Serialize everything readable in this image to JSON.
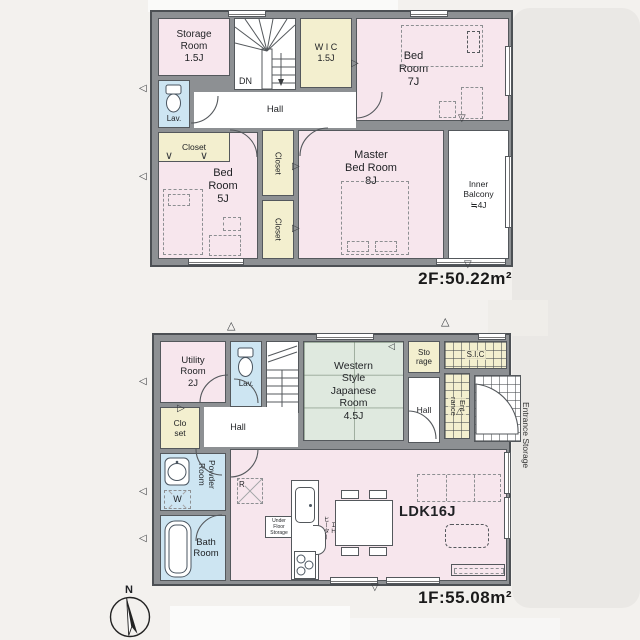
{
  "colors": {
    "room_pink": "#f7e6ed",
    "room_cream": "#f3efcf",
    "room_blue": "#cde5f2",
    "room_green": "#dfe9df",
    "wall": "#8d9093",
    "line": "#54585c",
    "bg": "#f3f1ee"
  },
  "icons": {
    "vent_left": "◁",
    "vent_right": "▷",
    "vent_up": "△",
    "vent_down": "▽",
    "fold": "∨"
  },
  "compass": {
    "label": "N"
  },
  "floor2": {
    "area_label": "2F:50.22m²",
    "storage_room": "Storage\nRoom\n1.5J",
    "wic": "W I C\n1.5J",
    "bedroom7": "Bed\nRoom\n7J",
    "lav": "Lav.",
    "dn": "DN",
    "hall": "Hall",
    "closet": "Closet",
    "bedroom5": "Bed\nRoom\n5J",
    "closet_a": "Closet",
    "closet_b": "Closet",
    "master_bedroom": "Master\nBed Room\n8J",
    "inner_balcony": "Inner\nBalcony\n≒4J"
  },
  "floor1": {
    "area_label": "1F:55.08m²",
    "utility_room": "Utility\nRoom\n2J",
    "lav": "Lav.",
    "up": "UP",
    "japanese_room": "Western\nStyle\nJapanese\nRoom\n4.5J",
    "storage": "Sto\nrage",
    "sic": "S.I.C",
    "entrance_hall": "Hall",
    "entrance": "Ent\nrance",
    "entrance_storage": "Entrance Storage",
    "closet": "Clo\nset",
    "hall": "Hall",
    "powder_room": "Powder\nRoom",
    "washer": "W",
    "bath_room": "Bath\nRoom",
    "fridge": "R",
    "under_floor_storage": "Under\nFloor\nStorage",
    "ih_heater": "ＩＨ\nヒーター",
    "ldk": "LDK16J"
  }
}
